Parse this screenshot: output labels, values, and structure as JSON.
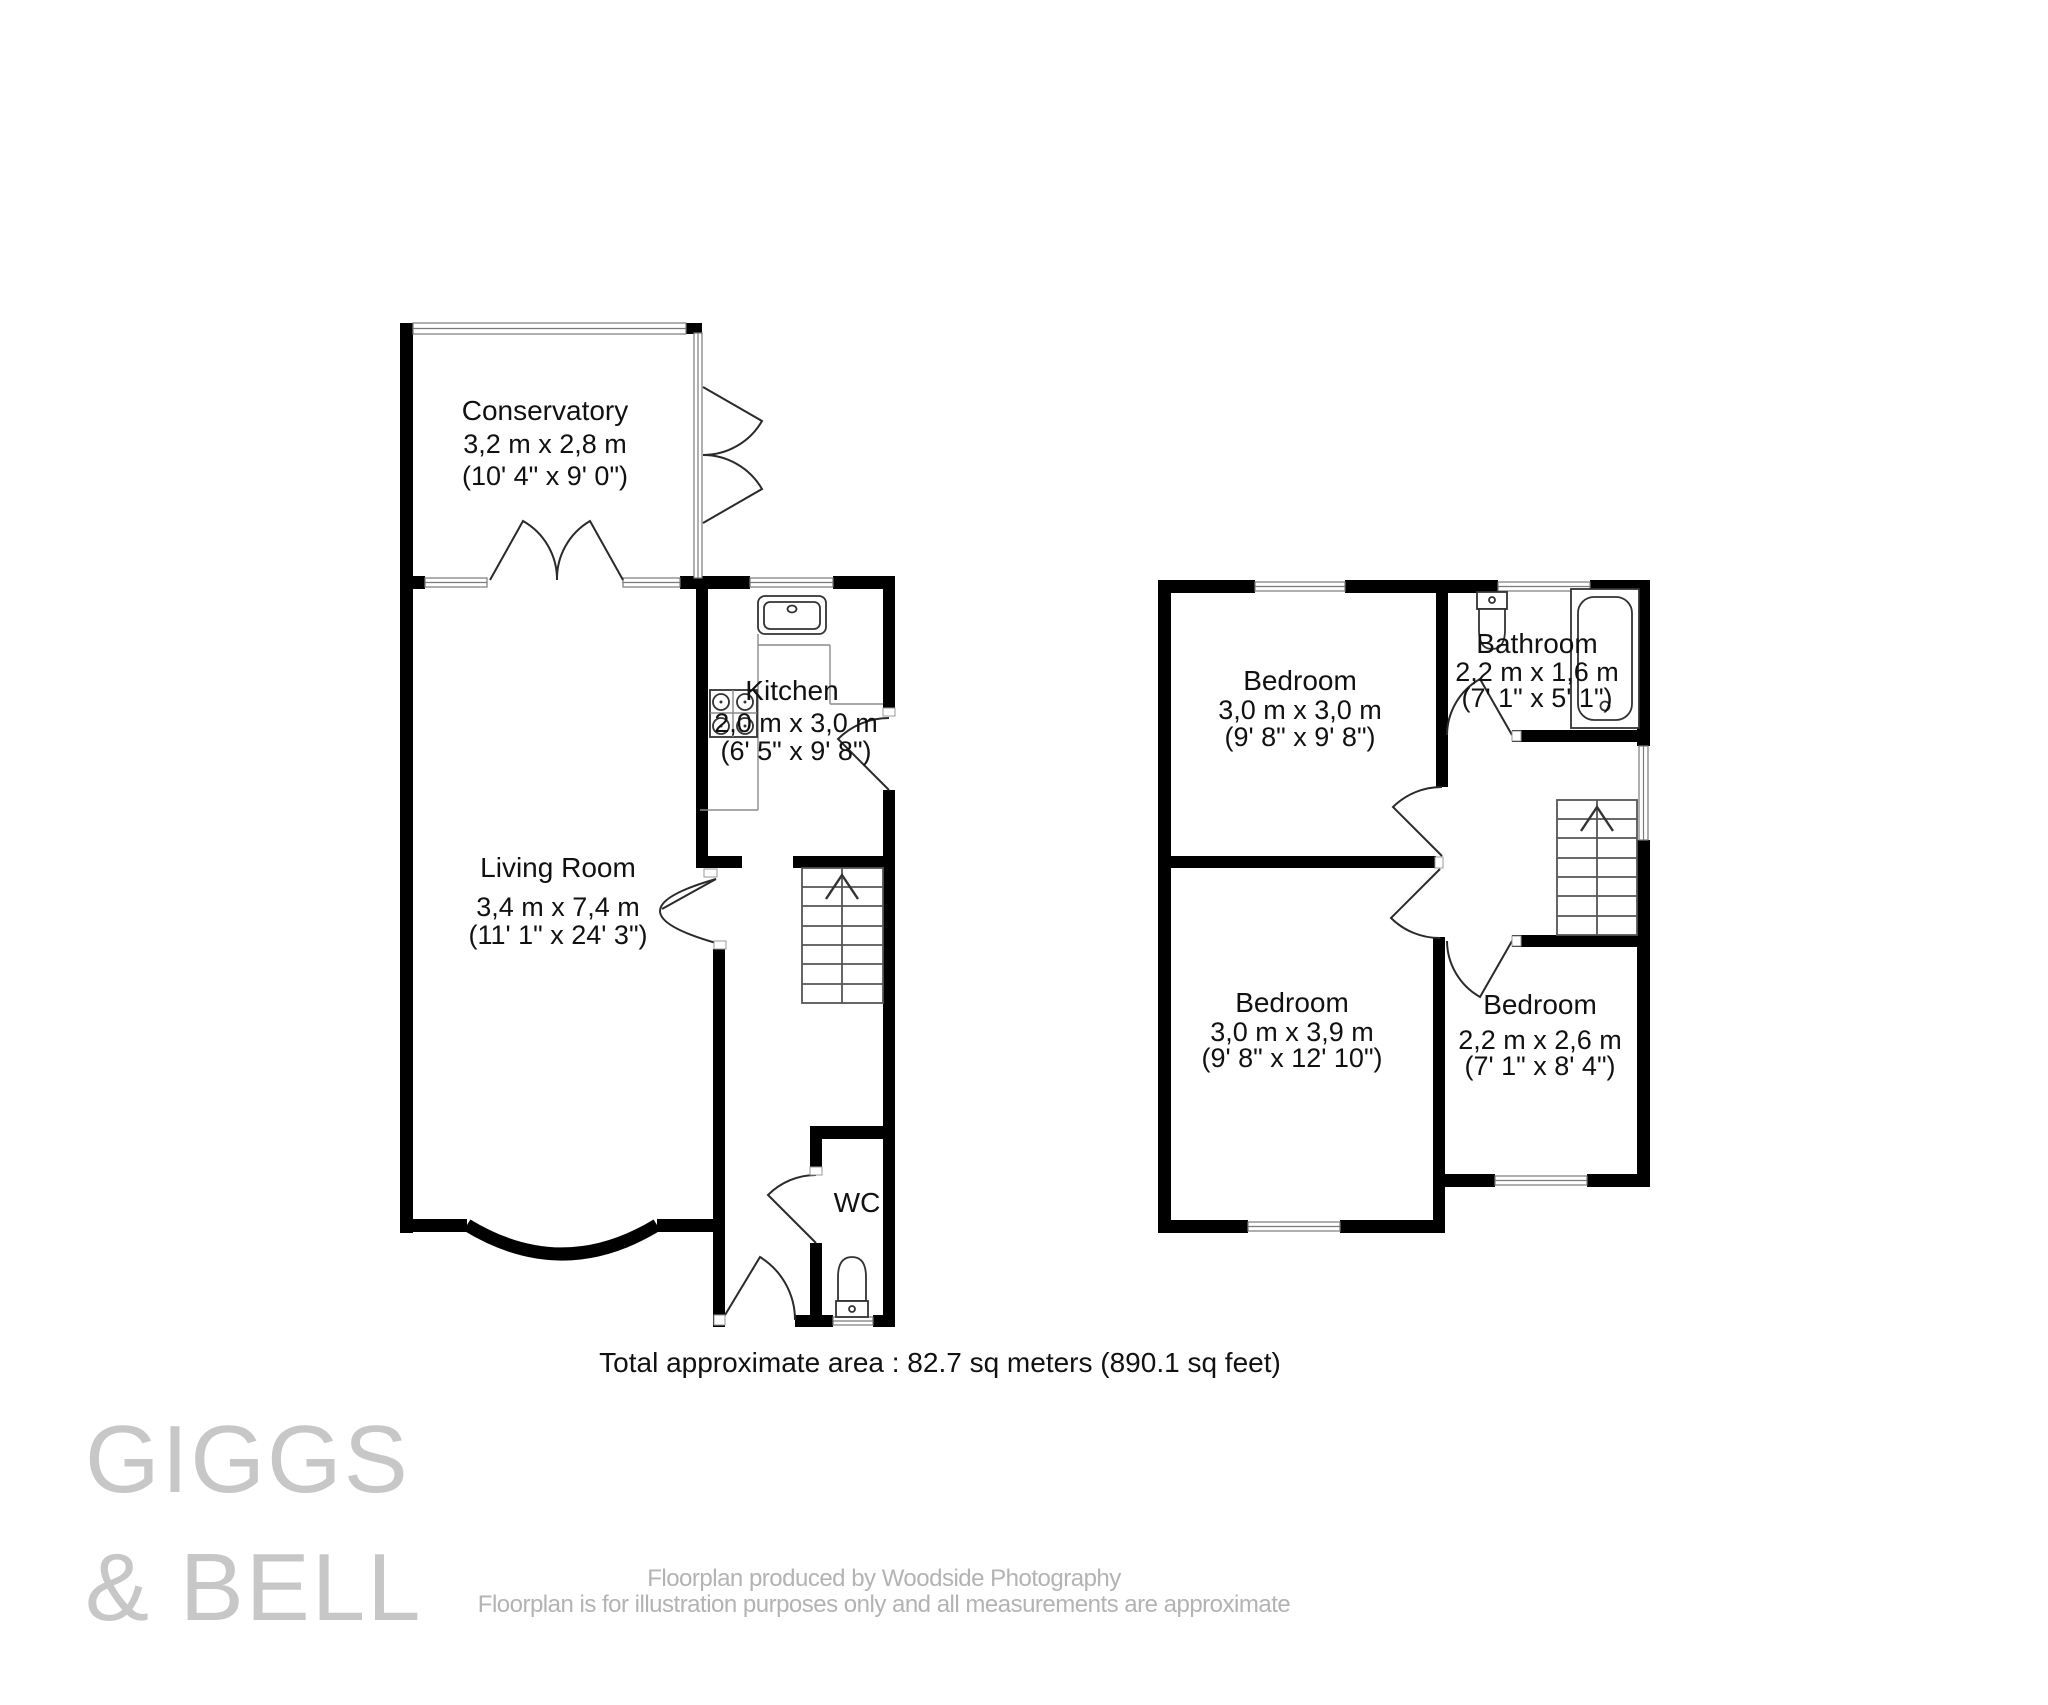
{
  "rooms": {
    "conservatory": {
      "label": "Conservatory",
      "metric": "3,2 m x 2,8 m",
      "imperial": "(10' 4\" x 9' 0\")"
    },
    "kitchen": {
      "label": "Kitchen",
      "metric": "2,0 m x 3,0 m",
      "imperial": "(6' 5\" x 9' 8\")"
    },
    "living_room": {
      "label": "Living Room",
      "metric": "3,4 m x 7,4 m",
      "imperial": "(11' 1\" x 24' 3\")"
    },
    "wc": {
      "label": "WC"
    },
    "bedroom_top": {
      "label": "Bedroom",
      "metric": "3,0 m x 3,0 m",
      "imperial": "(9' 8\" x 9' 8\")"
    },
    "bathroom": {
      "label": "Bathroom",
      "metric": "2,2 m x 1,6 m",
      "imperial": "(7' 1\" x 5' 1\")"
    },
    "bedroom_large": {
      "label": "Bedroom",
      "metric": "3,0 m x 3,9 m",
      "imperial": "(9' 8\" x 12' 10\")"
    },
    "bedroom_small": {
      "label": "Bedroom",
      "metric": "2,2 m x 2,6 m",
      "imperial": "(7' 1\" x 8' 4\")"
    }
  },
  "summary": {
    "total_area": "Total approximate area : 82.7 sq meters (890.1 sq feet)"
  },
  "branding": {
    "line1": "GIGGS",
    "line2": "& BELL",
    "logo_color": "#c7c7c7"
  },
  "footer": {
    "line1": "Floorplan produced by Woodside Photography",
    "line2": "Floorplan is for illustration purposes only and all measurements are approximate",
    "text_color": "#b3b3b3"
  },
  "colors": {
    "wall": "#000000",
    "label": "#111111"
  }
}
